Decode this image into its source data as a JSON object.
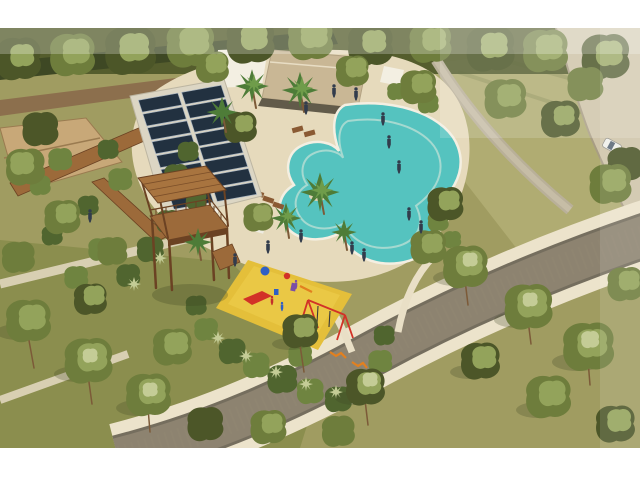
{
  "meta": {
    "kind": "aerial-architectural-render",
    "description": "Aerial 3D rendering of a residential park amenity: free-form pool, clubhouse, solar array, wooden lookout tower, playground, curved cobblestone road, dense trees",
    "width": 640,
    "height": 480
  },
  "frame": {
    "color": "#ffffff",
    "top_height": 28,
    "bottom_height": 32
  },
  "palette": {
    "grass_base": "#a09c61",
    "grass_light": "#b0ac72",
    "grass_dark": "#8b8e4e",
    "forest_dark": "#4c5628",
    "tree_mid": "#6e7d3c",
    "tree_light": "#93a35b",
    "tree_pale": "#c4cc96",
    "hedge_dark": "#3e4824",
    "path_brown": "#8c6f4d",
    "deck_sand": "#e6dabc",
    "pool_main": "#55c3bf",
    "pool_light": "#8addd6",
    "pool_edge": "#f4efe2",
    "pad_concrete": "#dcd6c4",
    "panel_dark": "#223140",
    "panel_grid": "#a8b4c0",
    "wood_mid": "#9c6a3a",
    "wood_roof": "#a8743f",
    "wood_dark": "#6b4223",
    "road_cobble": "#8d8370",
    "road_edge": "#6f6757",
    "sidewalk_cream": "#ece3cb",
    "lawn_path_gray": "#b9b099",
    "terrace_path": "#d8cfb2",
    "roof_tan": "#c9b795",
    "roof_shadow": "#4a4436",
    "canopy_white": "#f3efe2",
    "palapa_thatch": "#c8a878",
    "right_road_beige": "#cfc4a9",
    "play_yellow": "#e4bf3a",
    "play_yellow_hi": "#efd04e",
    "play_red": "#d23227",
    "play_blue": "#2f5fc5",
    "play_purple": "#7b4fa6",
    "play_orange": "#e2801f",
    "plant_dark": "#50652f",
    "plant_mid": "#6f8440",
    "plant_light": "#8fa25a",
    "palm_green": "#4e7c38",
    "palm_light": "#6f9c4a",
    "trunk_brown": "#7c5a38",
    "person_dark": "#323c4c",
    "lounger_brown": "#8a5a33",
    "lounger_white": "#efece2",
    "car_white": "#f0efea",
    "car_glass": "#5a6876",
    "shadow": "#3d4522",
    "haze_white": "#ffffff"
  },
  "objects": {
    "pool": {
      "label": "free-form swimming pool with palm island"
    },
    "clubhouse": {
      "label": "clubhouse with tan roof and white shade canopy"
    },
    "solar_array": {
      "label": "ground solar panel array",
      "rows": 8,
      "columns": 2
    },
    "lookout_tower": {
      "label": "two-story wooden lookout tower with railings"
    },
    "playground": {
      "label": "playground on yellow safety surface with slide and swings"
    },
    "road": {
      "label": "curved cobblestone road with cream sidewalk"
    },
    "access_road": {
      "label": "beige access road along right edge"
    },
    "car": {
      "label": "white car",
      "count": 1
    },
    "people": {
      "count": 14
    },
    "playground_children": {
      "count": 3
    },
    "pool_loungers": {
      "brown_count": 5,
      "white_count": 2
    },
    "umbrellas": {
      "count": 2
    }
  }
}
